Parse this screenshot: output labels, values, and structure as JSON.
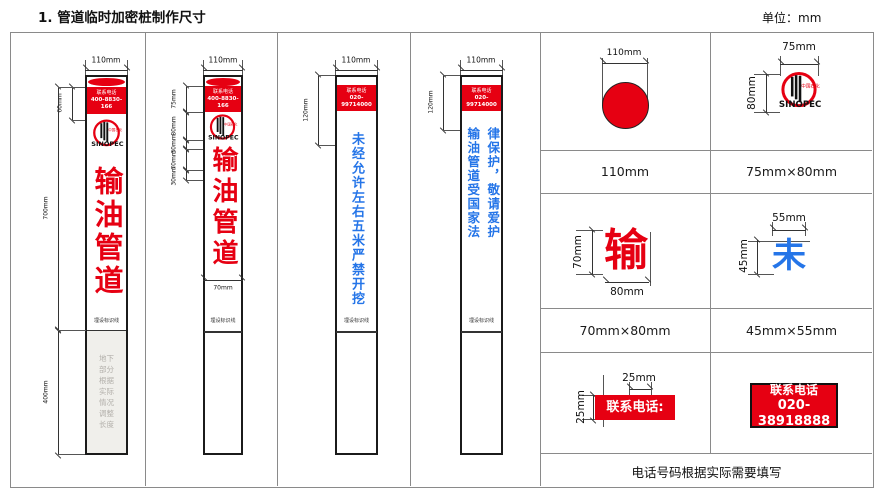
{
  "title": "1. 管道临时加密桩制作尺寸",
  "unit": "单位：mm",
  "colors": {
    "red": "#e60012",
    "blue": "#2575e8"
  },
  "logo": {
    "name": "中国石化",
    "brand": "SINOPEC"
  },
  "piles": [
    {
      "width_dim": "110mm",
      "phone_label": "联系电话",
      "phone": "400-8830-166",
      "body": "输油管道",
      "marker": "埋设标识线",
      "dim_header": "60mm",
      "dim_above": "700mm",
      "dim_below": "400mm",
      "underground": "地下部分根据实际情况调整长度"
    },
    {
      "width_dim": "110mm",
      "phone_label": "联系电话",
      "phone": "400-8830-166",
      "body": "输油管道",
      "marker": "埋设标识线",
      "dims": [
        "75mm",
        "80mm",
        "30mm",
        "70mm",
        "30mm"
      ],
      "char_width_dim": "70mm"
    },
    {
      "width_dim": "110mm",
      "phone_label": "联系电话",
      "phone": "020-99714000",
      "body": "未经允许左右五米严禁开挖",
      "marker": "埋设标识线",
      "dim_header": "120mm"
    },
    {
      "width_dim": "110mm",
      "phone_label": "联系电话",
      "phone": "020-99714000",
      "body_col1": "输油管道受国家法",
      "body_col2": "律保护，敬请爱护",
      "marker": "埋设标识线",
      "dim_header": "120mm"
    }
  ],
  "details": {
    "circle": {
      "dim": "110mm",
      "caption": "110mm"
    },
    "logo_cell": {
      "dim_w": "75mm",
      "dim_h": "80mm",
      "caption": "75mm×80mm"
    },
    "shu": {
      "glyph": "输",
      "dim_h": "70mm",
      "dim_w": "80mm",
      "caption": "70mm×80mm"
    },
    "wei": {
      "glyph": "未",
      "dim_w": "55mm",
      "dim_h": "45mm",
      "caption": "45mm×55mm"
    },
    "strip": {
      "text": "联系电话:",
      "dim_w": "25mm",
      "dim_h": "25mm"
    },
    "phone_box": {
      "label": "联系电话",
      "number": "020-38918888"
    },
    "note": "电话号码根据实际需要填写"
  }
}
